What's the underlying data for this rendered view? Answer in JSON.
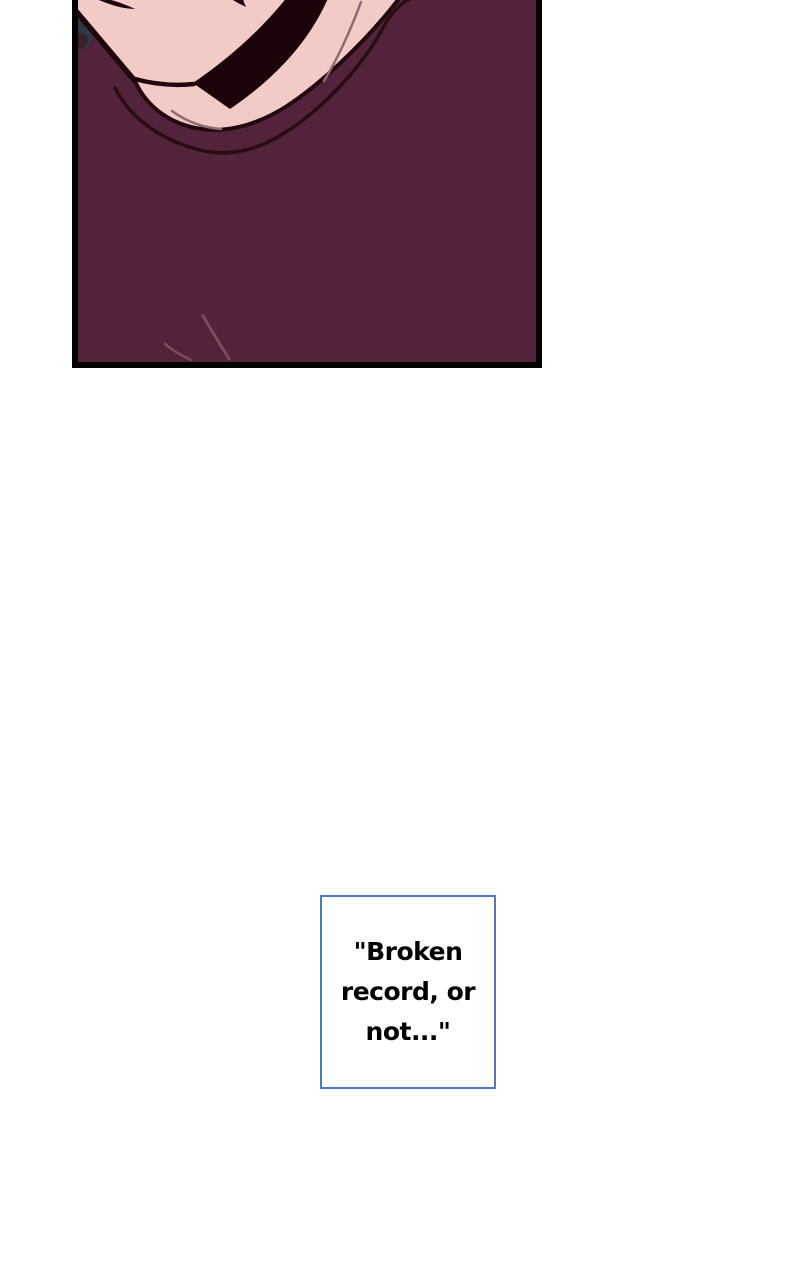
{
  "page": {
    "background": "#ffffff",
    "width": 800,
    "height": 1280
  },
  "comic_panel": {
    "description": "Cropped close-up of a character's chin and neck, wearing a dark plum crew-neck shirt with a black strap crossing the jaw",
    "border_color": "#000000",
    "colors": {
      "skin": "#f2cbc6",
      "shirt": "#52233a",
      "outline": "#1e060c",
      "collar_line": "#23080f",
      "collar_seam": "#2a0c14",
      "strap": "#1c0309",
      "hair": "#2e3b47",
      "hair_shadow": "#3a1f2d",
      "crease": "#8d6b6e",
      "fold": "#7b4c60"
    }
  },
  "caption": {
    "text": "\"Broken record, or not...\"",
    "lines": [
      "\"Broken",
      "record, or",
      "not...\""
    ],
    "border_color": "#4e7ab5",
    "background": "#ffffff",
    "text_color": "#000000"
  }
}
